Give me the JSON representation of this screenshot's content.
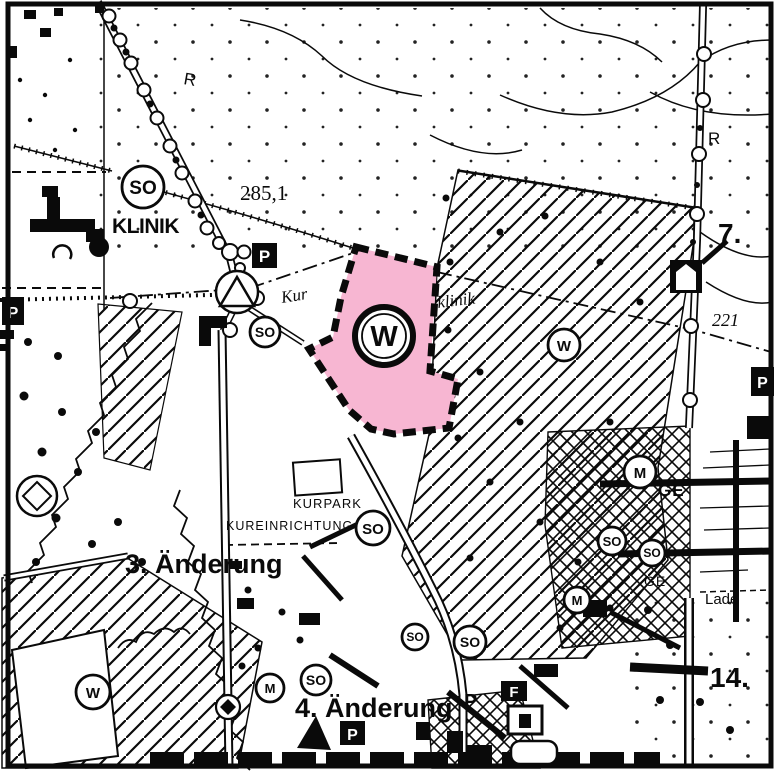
{
  "map": {
    "colors": {
      "highlight_pink": "#F7B6D2",
      "ink": "#0a0a0a"
    },
    "labels": {
      "klinik": "KLINIK",
      "kurpark": "KURPARK",
      "kureinrichtung": "KUREINRICHTUNG",
      "kur_fragment": "Kur",
      "klinik_fragment": "klinik",
      "lade": "Lade",
      "ge": "GE"
    },
    "annotations": {
      "change_3": "3. Änderung",
      "change_4": "4. Änderung",
      "ref_7": "7.",
      "ref_14": "14.",
      "elevation_285": "285,1",
      "elevation_221": "221"
    },
    "zone_symbols": {
      "so": "SO",
      "w": "W",
      "m": "M",
      "parking": "P",
      "f": "F",
      "r": "R"
    }
  }
}
